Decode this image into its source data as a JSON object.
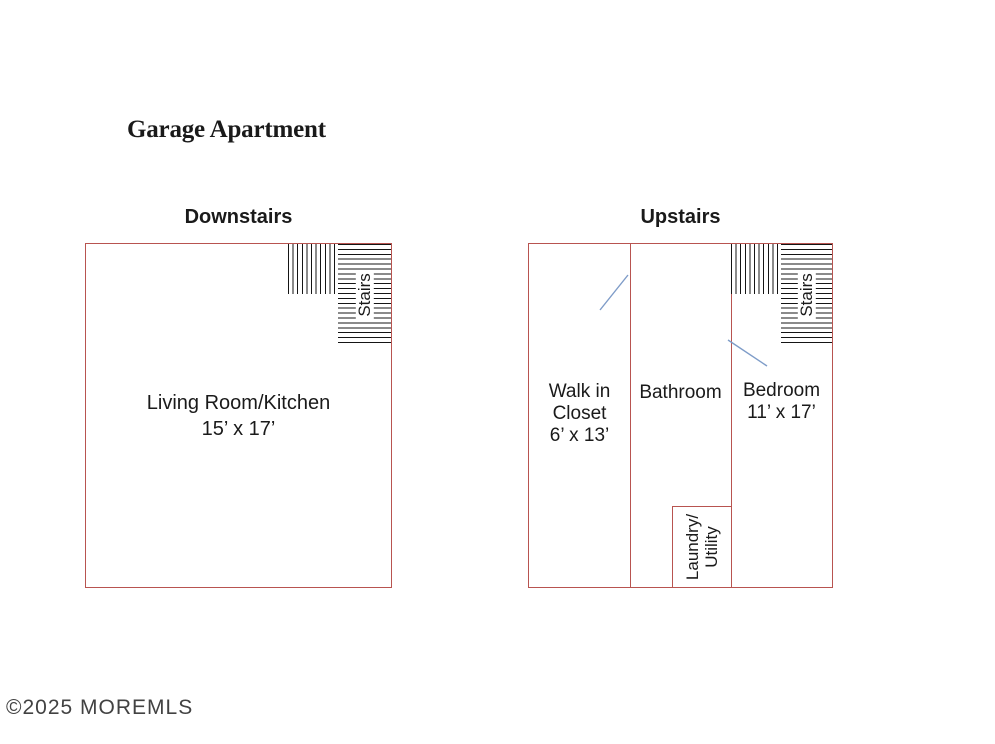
{
  "title": "Garage Apartment",
  "watermark": "©2025 MOREMLS",
  "colors": {
    "wall": "#b85450",
    "hatch": "#151515",
    "door": "#7e9cc8",
    "text": "#1a1a1a",
    "watermark": "#424242"
  },
  "downstairs": {
    "label": "Downstairs",
    "stairs_label": "Stairs",
    "room": {
      "name": "Living Room/Kitchen",
      "dimensions": "15’ x 17’"
    }
  },
  "upstairs": {
    "label": "Upstairs",
    "stairs_label": "Stairs",
    "rooms": {
      "walk_in_closet": {
        "name_line1": "Walk in",
        "name_line2": "Closet",
        "dimensions": "6’ x 13’"
      },
      "bathroom": {
        "name": "Bathroom"
      },
      "bedroom": {
        "name": "Bedroom",
        "dimensions": "11’ x 17’"
      },
      "laundry": {
        "name_line1": "Laundry/",
        "name_line2": "Utility"
      }
    }
  }
}
